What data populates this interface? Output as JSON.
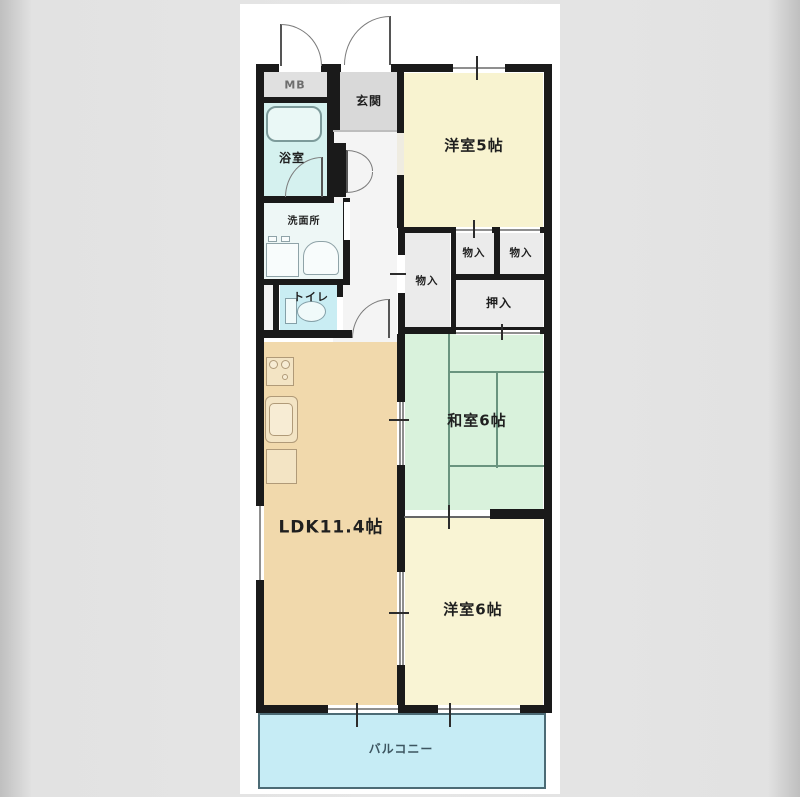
{
  "page": {
    "background_color": "#e6e6e6",
    "panel_color": "#ffffff"
  },
  "floorplan": {
    "rooms": {
      "mb": {
        "label": "MB"
      },
      "genkan": {
        "label": "玄関"
      },
      "western_room_5": {
        "label": "洋室5帖"
      },
      "bathroom": {
        "label": "浴室"
      },
      "washroom": {
        "label": "洗面所"
      },
      "toilet": {
        "label": "トイレ"
      },
      "storage_tall": {
        "label": "物入"
      },
      "storage_mid": {
        "label": "物入"
      },
      "storage_right": {
        "label": "物入"
      },
      "closet": {
        "label": "押入"
      },
      "japanese_room_6": {
        "label": "和室6帖"
      },
      "ldk": {
        "label": "LDK11.4帖"
      },
      "western_room_6": {
        "label": "洋室6帖"
      },
      "balcony": {
        "label": "バルコニー"
      }
    },
    "colors": {
      "wall": "#1a1a1a",
      "western_room": "#f8f3d0",
      "japanese_room": "#d9f2dc",
      "ldk": "#f1d9ac",
      "bathroom": "#d5f1ef",
      "toilet": "#c9edf3",
      "balcony": "#c6ecf5",
      "entrance": "#d9d9d9",
      "storage": "#ebebeb",
      "hallway": "#f4f4f4",
      "tatami_line": "#6a947f"
    }
  }
}
